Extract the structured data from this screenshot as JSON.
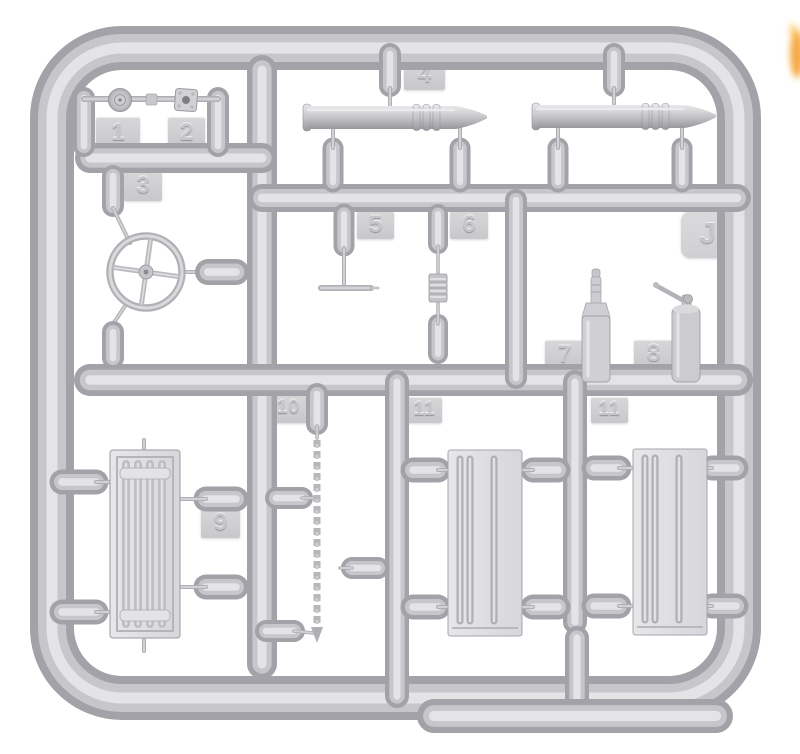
{
  "scene": {
    "background_color": "#ffffff",
    "plastic_color": "#c7c7cb",
    "plastic_highlight": "#e4e4e7",
    "plastic_shadow": "#a2a2a8",
    "edge_object_color": "#f59b23"
  },
  "sprue": {
    "frame_code": "Jf",
    "tags": [
      {
        "label": "1"
      },
      {
        "label": "2"
      },
      {
        "label": "3"
      },
      {
        "label": "4"
      },
      {
        "label": "5"
      },
      {
        "label": "6"
      },
      {
        "label": "7"
      },
      {
        "label": "8"
      },
      {
        "label": "9"
      },
      {
        "label": "10"
      },
      {
        "label": "11"
      },
      {
        "label": "11"
      }
    ],
    "parts": [
      {
        "tag": "1",
        "name": "round-knob"
      },
      {
        "tag": "2",
        "name": "square-flange"
      },
      {
        "tag": "3",
        "name": "steering-wheel"
      },
      {
        "tag": "4",
        "name": "artillery-shell",
        "count": 2
      },
      {
        "tag": "5",
        "name": "t-handle"
      },
      {
        "tag": "6",
        "name": "ribbed-coupler"
      },
      {
        "tag": "7",
        "name": "bottle"
      },
      {
        "tag": "8",
        "name": "cylinder-with-lever"
      },
      {
        "tag": "9",
        "name": "radiator"
      },
      {
        "tag": "10",
        "name": "chain"
      },
      {
        "tag": "11",
        "name": "ribbed-panel",
        "count": 2
      }
    ]
  }
}
